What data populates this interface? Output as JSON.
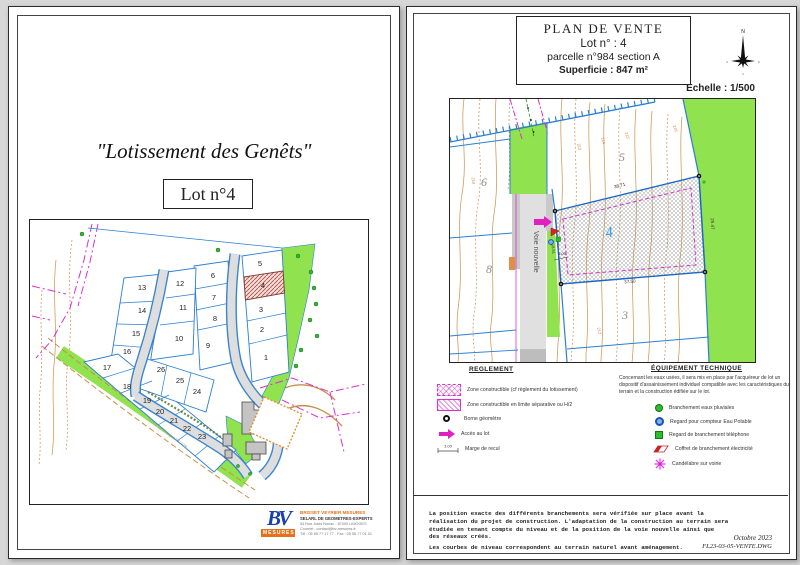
{
  "page_left": {
    "title": "\"Lotissement des Genêts\"",
    "lot_label": "Lot n°4",
    "map": {
      "road_label": "Route de Limoges RD 979",
      "highlighted_lot": "4",
      "lots": [
        {
          "n": "1",
          "x": 236,
          "y": 140
        },
        {
          "n": "2",
          "x": 232,
          "y": 112
        },
        {
          "n": "3",
          "x": 231,
          "y": 92
        },
        {
          "n": "4",
          "x": 233,
          "y": 68
        },
        {
          "n": "5",
          "x": 230,
          "y": 46
        },
        {
          "n": "6",
          "x": 183,
          "y": 58
        },
        {
          "n": "7",
          "x": 184,
          "y": 80
        },
        {
          "n": "8",
          "x": 185,
          "y": 101
        },
        {
          "n": "9",
          "x": 178,
          "y": 128
        },
        {
          "n": "10",
          "x": 149,
          "y": 121
        },
        {
          "n": "11",
          "x": 153,
          "y": 90
        },
        {
          "n": "12",
          "x": 150,
          "y": 66
        },
        {
          "n": "13",
          "x": 112,
          "y": 70
        },
        {
          "n": "14",
          "x": 112,
          "y": 93
        },
        {
          "n": "15",
          "x": 106,
          "y": 116
        },
        {
          "n": "16",
          "x": 97,
          "y": 134
        },
        {
          "n": "17",
          "x": 77,
          "y": 150
        },
        {
          "n": "18",
          "x": 97,
          "y": 169
        },
        {
          "n": "19",
          "x": 117,
          "y": 183
        },
        {
          "n": "20",
          "x": 130,
          "y": 194
        },
        {
          "n": "21",
          "x": 144,
          "y": 203
        },
        {
          "n": "22",
          "x": 157,
          "y": 211
        },
        {
          "n": "23",
          "x": 172,
          "y": 219
        },
        {
          "n": "24",
          "x": 167,
          "y": 174
        },
        {
          "n": "25",
          "x": 150,
          "y": 163
        },
        {
          "n": "26",
          "x": 131,
          "y": 152
        }
      ]
    },
    "logo": {
      "initials": "BV",
      "brand": "MESURES",
      "company": "BRISSET VEYRIER MESURES",
      "subtitle": "SELARL DE GEOMETRES-EXPERTS",
      "address": "54 Rue Jules Noriac - 87000 LIMOGES",
      "contact": "Courriel : contact@bv-mesures.fr",
      "phone": "Tél : 05 55 77 17 77 - Fax : 05 55 77 01 01"
    }
  },
  "page_right": {
    "title_block": {
      "line1": "PLAN DE VENTE",
      "line2": "Lot  n° : 4",
      "line3": "parcelle n°984 section A",
      "line4": "Superficie : 847 m²"
    },
    "scale_label": "Echelle : 1/500",
    "compass": {
      "north": "N",
      "east": "E",
      "south": "S",
      "west": "O"
    },
    "plan": {
      "road_label": "Voie nouvelle",
      "lot_number": "4",
      "neighbor_lots": [
        {
          "n": "5",
          "x": 172,
          "y": 62
        },
        {
          "n": "6",
          "x": 34,
          "y": 87
        },
        {
          "n": "8",
          "x": 39,
          "y": 174
        },
        {
          "n": "3",
          "x": 175,
          "y": 220
        }
      ],
      "dimensions": {
        "top": "38.71",
        "right": "25.47",
        "bottom": "37.50",
        "left": "18.51",
        "setback": "3.00"
      },
      "contour_labels": [
        {
          "t": "213",
          "x": 128,
          "y": 48,
          "r": 78
        },
        {
          "t": "214",
          "x": 152,
          "y": 42,
          "r": 75
        },
        {
          "t": "215",
          "x": 176,
          "y": 37,
          "r": 73
        },
        {
          "t": "216",
          "x": 224,
          "y": 30,
          "r": 68
        },
        {
          "t": "214",
          "x": 22,
          "y": 82,
          "r": 84
        },
        {
          "t": "212",
          "x": 148,
          "y": 232,
          "r": 80
        }
      ]
    },
    "reglement": {
      "heading": "REGLEMENT",
      "items": [
        {
          "label": "Zone constructible (cf règlement du lotissement)"
        },
        {
          "label": "Zone constructible en limite séparative ou H/2"
        },
        {
          "label": "Borne géomètre"
        },
        {
          "label": "Accès au lot"
        },
        {
          "label": "Marge de recul"
        }
      ],
      "setback_value": "3.00"
    },
    "equipement": {
      "heading": "ÉQUIPEMENT TECHNIQUE",
      "note": "Concernant les eaux usées, il sera mis en place par l'acquéreur de lot un dispositif d'assainissement individuel compatible avec les caractéristiques du terrain et la construction édifiée sur le lot.",
      "items": [
        {
          "label": "Branchement  eaux pluviales"
        },
        {
          "label": "Regard pour compteur Eau Potable"
        },
        {
          "label": "Regard de branchement téléphone"
        },
        {
          "label": "Coffret de branchement électricité"
        },
        {
          "label": "Candélabre sur voirie"
        }
      ]
    },
    "footer": {
      "paragraph1": "La position exacte des différents branchements sera vérifiée sur place  avant la\nréalisation du projet de construction. L'adaptation de la construction au terrain sera\nétudiée en tenant compte du niveau et de la position de la voie nouvelle ainsi que\ndes réseaux créés.",
      "paragraph2": "Les courbes de niveau correspondent au terrain naturel avant aménagement.",
      "date": "Octobre 2023",
      "file": "FL23-03-05-VENTE.DWG"
    }
  },
  "colors": {
    "parcel_blue": "#2a7fd4",
    "lot_boundary_blue": "#1b66c9",
    "magenta": "#d832cc",
    "green_space": "#90e34f",
    "contour_tan": "#c98f4a",
    "road_gray": "#dcdcdc",
    "highlight_hatch_red": "#b5524a",
    "lot_label_blue": "#2e9fe6"
  }
}
